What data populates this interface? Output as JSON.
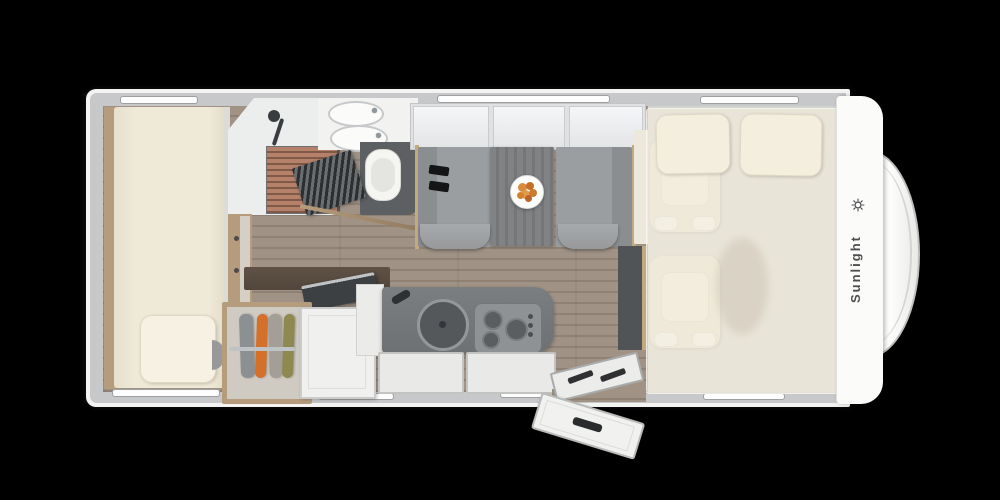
{
  "brand": {
    "logo_text": "Sunlight",
    "logo_icon": "sun-icon"
  },
  "floorplan": {
    "type": "motorhome-top-view",
    "areas": [
      {
        "name": "rear-bed",
        "items": [
          "mattress",
          "pillow",
          "side-step"
        ]
      },
      {
        "name": "bathroom",
        "items": [
          "shower",
          "wood-slat-tray",
          "shower-fixture",
          "double-washbasin",
          "toilet",
          "folding-louver-door"
        ]
      },
      {
        "name": "wardrobe",
        "items": [
          "hanging-clothes",
          "open-white-door",
          "tv-panel",
          "dark-shelf"
        ]
      },
      {
        "name": "kitchen",
        "items": [
          "round-sink",
          "faucet",
          "three-burner-stove",
          "drawers",
          "side-cabinet"
        ]
      },
      {
        "name": "dinette",
        "items": [
          "bench-left",
          "bench-right",
          "table",
          "fruit-plate",
          "seatbelts",
          "overhead-lockers"
        ]
      },
      {
        "name": "cab",
        "items": [
          "cab-seat-1",
          "cab-seat-2",
          "drop-down-bed",
          "pillow-left",
          "pillow-right",
          "dashboard"
        ]
      },
      {
        "name": "entrance",
        "items": [
          "entry-step",
          "open-entry-door"
        ]
      }
    ],
    "palette": {
      "background": "#000000",
      "shell": "#f3f3f2",
      "wall": "#c6c8c9",
      "floor_wood": "#9a8c7e",
      "mattress": "#efe9d8",
      "pillow": "#f6f1e3",
      "fabric_gray": "#9b9ea0",
      "table_gray": "#7b7d7f",
      "counter_dark": "#6e7173",
      "stove_gray": "#8e9295",
      "trim_wood": "#b59c7d",
      "shelf_dark": "#52463c",
      "garment_orange": "#d4702a",
      "garment_olive": "#8e8950",
      "slats_wood": "#b5816b",
      "toilet_floor": "#5d6062",
      "logo_color": "#4c4e50"
    }
  }
}
